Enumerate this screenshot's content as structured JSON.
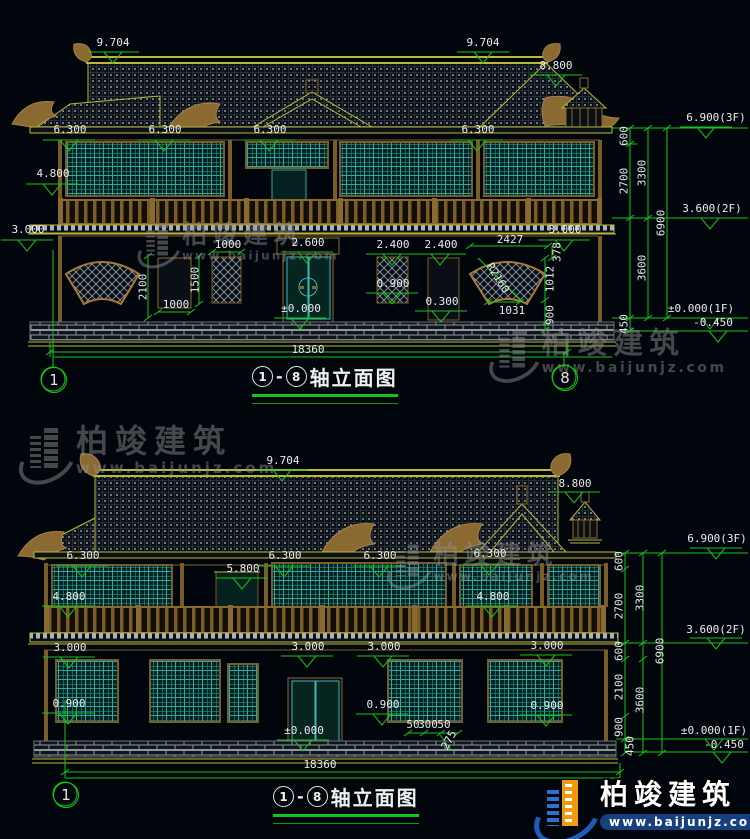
{
  "watermark": {
    "name": "柏竣建筑",
    "url": "www.baijunjz.com"
  },
  "brand": {
    "name": "柏竣建筑",
    "url": "www.baijunjz.com"
  },
  "drawings": [
    {
      "title": {
        "start": "1",
        "sep": "-",
        "end": "8",
        "text": "轴立面图"
      },
      "axis_left": "1",
      "axis_right": "8",
      "labels": [
        {
          "t": "9.704",
          "x": 113,
          "y": 37
        },
        {
          "t": "9.704",
          "x": 483,
          "y": 37
        },
        {
          "t": "8.800",
          "x": 556,
          "y": 60
        },
        {
          "t": "6.300",
          "x": 70,
          "y": 124
        },
        {
          "t": "6.300",
          "x": 165,
          "y": 124
        },
        {
          "t": "6.300",
          "x": 270,
          "y": 124
        },
        {
          "t": "6.300",
          "x": 478,
          "y": 124
        },
        {
          "t": "4.800",
          "x": 53,
          "y": 168
        },
        {
          "t": "3.000",
          "x": 28,
          "y": 224
        },
        {
          "t": "3.000",
          "x": 565,
          "y": 224
        },
        {
          "t": "2.600",
          "x": 308,
          "y": 237
        },
        {
          "t": "2.400",
          "x": 393,
          "y": 239
        },
        {
          "t": "2.400",
          "x": 441,
          "y": 239
        },
        {
          "t": "1000",
          "x": 228,
          "y": 239
        },
        {
          "t": "0.900",
          "x": 393,
          "y": 278
        },
        {
          "t": "0.300",
          "x": 442,
          "y": 296
        },
        {
          "t": "±0.000",
          "x": 301,
          "y": 303
        },
        {
          "t": "1000",
          "x": 176,
          "y": 299
        },
        {
          "t": "2100",
          "x": 143,
          "y": 287,
          "r": -90
        },
        {
          "t": "1500",
          "x": 195,
          "y": 280,
          "r": -90
        },
        {
          "t": "2427",
          "x": 510,
          "y": 234
        },
        {
          "t": "378",
          "x": 557,
          "y": 252,
          "r": -90
        },
        {
          "t": "R2160",
          "x": 498,
          "y": 278,
          "r": 58
        },
        {
          "t": "1012",
          "x": 550,
          "y": 279,
          "r": -90
        },
        {
          "t": "1031",
          "x": 512,
          "y": 305
        },
        {
          "t": "900",
          "x": 550,
          "y": 315,
          "r": -90
        },
        {
          "t": "600",
          "x": 624,
          "y": 136,
          "r": -90
        },
        {
          "t": "2700",
          "x": 624,
          "y": 181,
          "r": -90
        },
        {
          "t": "3300",
          "x": 642,
          "y": 173,
          "r": -90
        },
        {
          "t": "6900",
          "x": 661,
          "y": 223,
          "r": -90
        },
        {
          "t": "3600",
          "x": 642,
          "y": 268,
          "r": -90
        },
        {
          "t": "450",
          "x": 624,
          "y": 324,
          "r": -90
        },
        {
          "t": "6.900(3F)",
          "x": 716,
          "y": 112
        },
        {
          "t": "3.600(2F)",
          "x": 712,
          "y": 203
        },
        {
          "t": "±0.000(1F)",
          "x": 701,
          "y": 303
        },
        {
          "t": "-0.450",
          "x": 713,
          "y": 317
        },
        {
          "t": "18360",
          "x": 308,
          "y": 344
        }
      ]
    },
    {
      "title": {
        "start": "1",
        "sep": "-",
        "end": "8",
        "text": "轴立面图"
      },
      "axis_left": "1",
      "labels": [
        {
          "t": "9.704",
          "x": 283,
          "y": 455
        },
        {
          "t": "8.800",
          "x": 575,
          "y": 478
        },
        {
          "t": "6.300",
          "x": 83,
          "y": 550
        },
        {
          "t": "6.300",
          "x": 285,
          "y": 550
        },
        {
          "t": "6.300",
          "x": 380,
          "y": 550
        },
        {
          "t": "6.300",
          "x": 490,
          "y": 548
        },
        {
          "t": "5.800",
          "x": 243,
          "y": 563
        },
        {
          "t": "4.800",
          "x": 69,
          "y": 591
        },
        {
          "t": "4.800",
          "x": 493,
          "y": 591
        },
        {
          "t": "3.000",
          "x": 70,
          "y": 642
        },
        {
          "t": "3.000",
          "x": 308,
          "y": 641
        },
        {
          "t": "3.000",
          "x": 384,
          "y": 641
        },
        {
          "t": "3.000",
          "x": 547,
          "y": 640
        },
        {
          "t": "0.900",
          "x": 69,
          "y": 698
        },
        {
          "t": "0.900",
          "x": 383,
          "y": 699
        },
        {
          "t": "0.900",
          "x": 547,
          "y": 700
        },
        {
          "t": "±0.000",
          "x": 304,
          "y": 725
        },
        {
          "t": "50",
          "x": 413,
          "y": 719
        },
        {
          "t": "300",
          "x": 428,
          "y": 719
        },
        {
          "t": "50",
          "x": 444,
          "y": 719
        },
        {
          "t": "275",
          "x": 449,
          "y": 740,
          "r": -62
        },
        {
          "t": "18360",
          "x": 320,
          "y": 759
        },
        {
          "t": "600",
          "x": 619,
          "y": 561,
          "r": -90
        },
        {
          "t": "2700",
          "x": 619,
          "y": 606,
          "r": -90
        },
        {
          "t": "3300",
          "x": 640,
          "y": 598,
          "r": -90
        },
        {
          "t": "600",
          "x": 619,
          "y": 651,
          "r": -90
        },
        {
          "t": "2100",
          "x": 619,
          "y": 687,
          "r": -90
        },
        {
          "t": "3600",
          "x": 640,
          "y": 700,
          "r": -90
        },
        {
          "t": "6900",
          "x": 660,
          "y": 651,
          "r": -90
        },
        {
          "t": "900",
          "x": 619,
          "y": 727,
          "r": -90
        },
        {
          "t": "450",
          "x": 630,
          "y": 746,
          "r": -90
        },
        {
          "t": "6.900(3F)",
          "x": 717,
          "y": 533
        },
        {
          "t": "3.600(2F)",
          "x": 716,
          "y": 624
        },
        {
          "t": "±0.000(1F)",
          "x": 714,
          "y": 725
        },
        {
          "t": "-0.450",
          "x": 724,
          "y": 739
        }
      ]
    }
  ]
}
